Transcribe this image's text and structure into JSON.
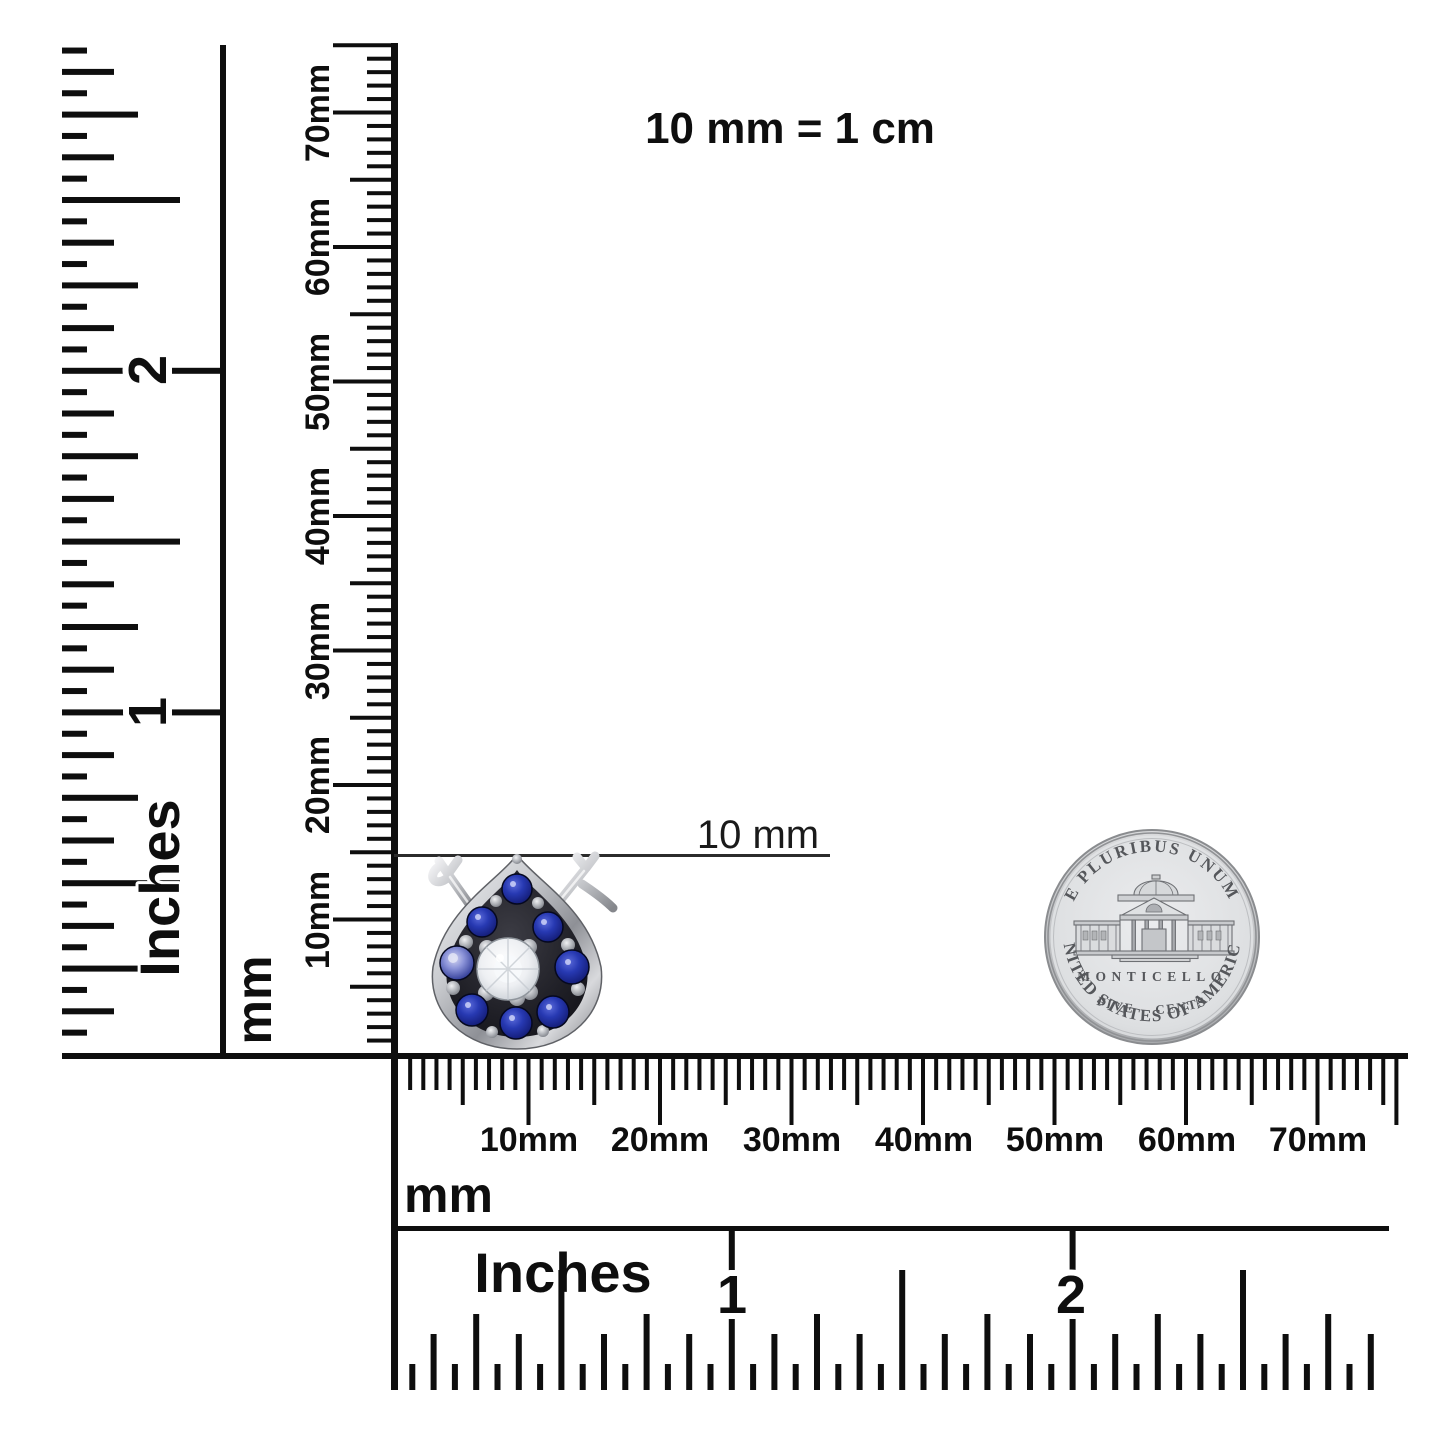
{
  "page": {
    "background": "#ffffff",
    "ink": "#0e0e0e",
    "top_note": "10 mm = 1 cm"
  },
  "callout": {
    "label": "10 mm"
  },
  "rulers": {
    "vertical_inches": {
      "unit_label": "Inches",
      "numerals": [
        "1",
        "2"
      ]
    },
    "vertical_mm": {
      "unit_label": "mm",
      "labels": [
        "10mm",
        "20mm",
        "30mm",
        "40mm",
        "50mm",
        "60mm",
        "70mm"
      ]
    },
    "horizontal_mm": {
      "unit_label": "mm",
      "labels": [
        "10mm",
        "20mm",
        "30mm",
        "40mm",
        "50mm",
        "60mm",
        "70mm"
      ]
    },
    "horizontal_inches": {
      "unit_label": "Inches",
      "numerals": [
        "1",
        "2"
      ]
    }
  },
  "jewelry": {
    "description": "Pear-shaped stud earring with blue sapphire halo and round white diamond center",
    "colors": {
      "metal": "#d8d9dc",
      "sapphire": "#1c2b96",
      "diamond": "#eef0f3",
      "pave_field": "#1b1b20"
    }
  },
  "coin": {
    "legend_top": "E PLURIBUS UNUM",
    "building_label": "MONTICELLO",
    "denomination": "FIVE CENTS",
    "legend_bottom": "UNITED STATES OF AMERICA",
    "colors": {
      "face": "#e0e2e4",
      "rim": "#c0c2c5",
      "engraving": "#55575b"
    }
  }
}
